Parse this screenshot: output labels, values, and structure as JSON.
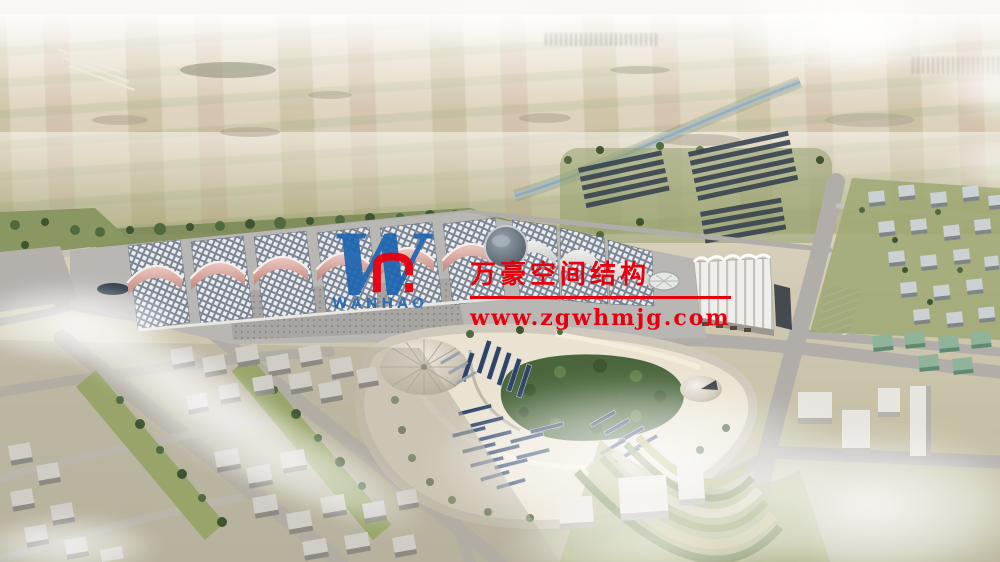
{
  "watermark": {
    "logo_letter": "W",
    "logo_monogram": "n",
    "logo_text": "WANHAO",
    "title_cn": "万豪空间结构",
    "url": "www.zgwhmjg.com",
    "text_red": "#e8000f",
    "logo_blue": "#1d65b2"
  },
  "palette": {
    "canopy_pink": "#d8a49c",
    "hall_roof_grid": "#7c8591",
    "panel_navy": "#2e4366",
    "park_sand": "#eae3d2",
    "forest_green": "#4b663c",
    "road_gray": "#b1aeaa",
    "field_tan": "#ddd3bd",
    "sky_haze": "#faf8f6"
  }
}
